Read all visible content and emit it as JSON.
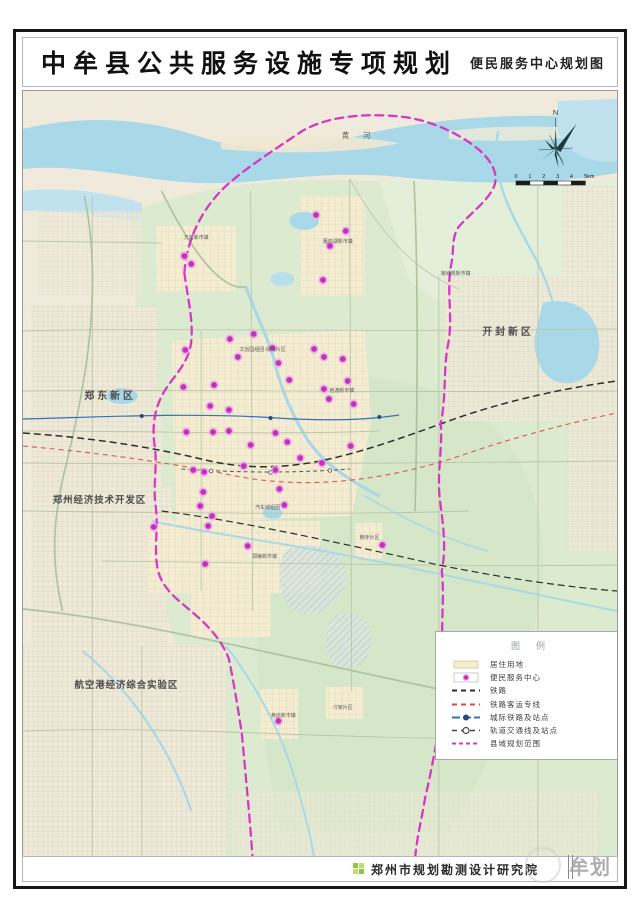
{
  "header": {
    "title": "中牟县公共服务设施专项规划",
    "subtitle": "便民服务中心规划图"
  },
  "map": {
    "river_label": "黄 河",
    "north_label": "N",
    "scale_ticks": [
      "0",
      "1",
      "2",
      "3",
      "4",
      "5km"
    ],
    "regions": [
      {
        "text": "郑东新区"
      },
      {
        "text": "开封新区"
      },
      {
        "text": "郑州经济技术开发区"
      },
      {
        "text": "航空港经济综合实验区"
      }
    ],
    "towns": [
      {
        "text": "雁鸣湖新市镇"
      },
      {
        "text": "万滩新市镇"
      },
      {
        "text": "狼城岗新市镇"
      },
      {
        "text": "官渡新市镇"
      },
      {
        "text": "文创园组团·绿博片区"
      },
      {
        "text": "汽车城组团"
      },
      {
        "text": "郑庵新市镇"
      },
      {
        "text": "韩寺片区"
      },
      {
        "text": "黄店新市镇"
      },
      {
        "text": "刁家片区"
      }
    ],
    "dots": [
      [
        296,
        124
      ],
      [
        326,
        140
      ],
      [
        310,
        155
      ],
      [
        303,
        189
      ],
      [
        163,
        165
      ],
      [
        170,
        173
      ],
      [
        209,
        248
      ],
      [
        233,
        243
      ],
      [
        164,
        259
      ],
      [
        217,
        266
      ],
      [
        252,
        257
      ],
      [
        258,
        272
      ],
      [
        294,
        258
      ],
      [
        304,
        266
      ],
      [
        323,
        268
      ],
      [
        162,
        296
      ],
      [
        193,
        294
      ],
      [
        269,
        289
      ],
      [
        304,
        298
      ],
      [
        328,
        290
      ],
      [
        189,
        315
      ],
      [
        208,
        319
      ],
      [
        309,
        308
      ],
      [
        334,
        313
      ],
      [
        165,
        341
      ],
      [
        192,
        341
      ],
      [
        208,
        340
      ],
      [
        230,
        354
      ],
      [
        255,
        342
      ],
      [
        267,
        351
      ],
      [
        331,
        355
      ],
      [
        172,
        379
      ],
      [
        183,
        381
      ],
      [
        223,
        375
      ],
      [
        255,
        379
      ],
      [
        280,
        367
      ],
      [
        302,
        372
      ],
      [
        182,
        401
      ],
      [
        259,
        398
      ],
      [
        264,
        414
      ],
      [
        179,
        415
      ],
      [
        191,
        425
      ],
      [
        132,
        436
      ],
      [
        187,
        435
      ],
      [
        227,
        455
      ],
      [
        184,
        473
      ],
      [
        363,
        454
      ],
      [
        258,
        630
      ]
    ]
  },
  "legend": {
    "title": "图例",
    "items": [
      {
        "label": "居住用地",
        "type": "residential"
      },
      {
        "label": "便民服务中心",
        "type": "service-center"
      },
      {
        "label": "铁路",
        "type": "railway"
      },
      {
        "label": "铁路客运专线",
        "type": "passenger-rail"
      },
      {
        "label": "城际铁路及站点",
        "type": "intercity-rail"
      },
      {
        "label": "轨道交通线及站点",
        "type": "rail-transit"
      },
      {
        "label": "县域规划范围",
        "type": "county-boundary"
      }
    ]
  },
  "footer": {
    "institute": "郑州市规划勘测设计研究院",
    "watermark": "牟划"
  },
  "colors": {
    "dot": "#c52fc0",
    "dot_halo": "#eaa8e4",
    "boundary": "#d837c6",
    "water": "#a9d9e8",
    "green_land": "#dcebd0",
    "residential": "#f5eecd",
    "railway": "#2e2e2e",
    "passenger_rail": "#e04545",
    "intercity_rail": "#3a6fb5",
    "logo_green": "#8dc63f"
  }
}
